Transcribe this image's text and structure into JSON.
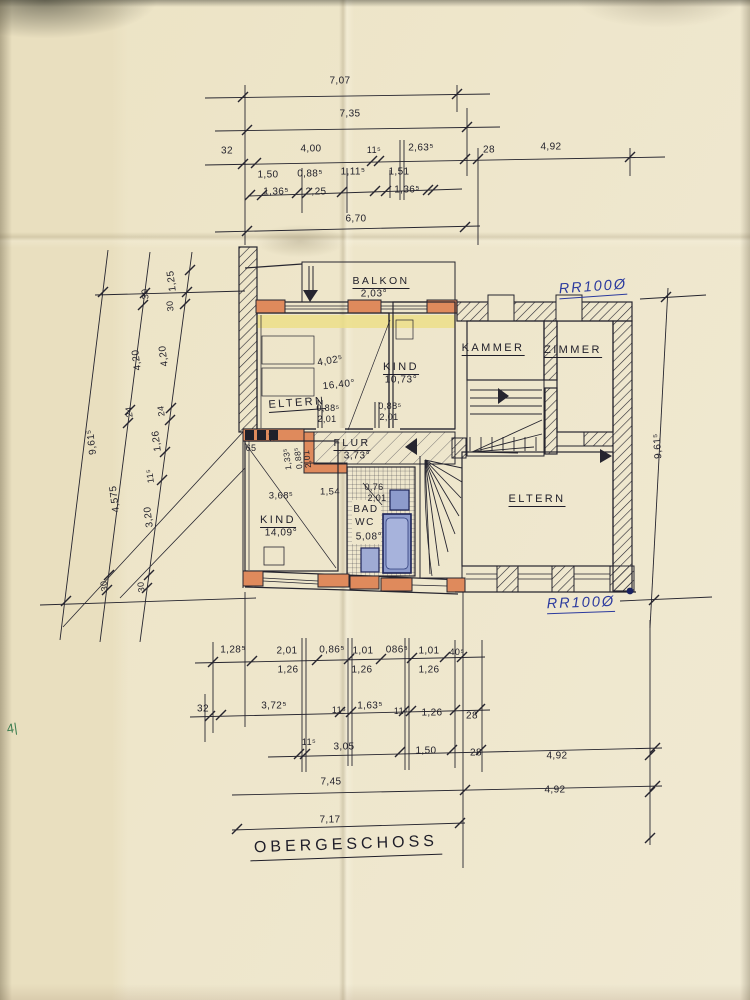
{
  "title": "OBERGESCHOSS",
  "notes": {
    "rr_top": "RR100Ø",
    "rr_bottom": "RR100Ø",
    "green_mark": "4|"
  },
  "rooms": {
    "balkon": {
      "name": "BALKON",
      "area": "2,03°"
    },
    "eltern_top": {
      "name": "ELTERN",
      "area": "16,40°",
      "width": "4,02⁵"
    },
    "kind_top": {
      "name": "KIND",
      "area": "10,73°"
    },
    "kammer": {
      "name": "KAMMER"
    },
    "zimmer": {
      "name": "ZIMMER"
    },
    "flur": {
      "name": "FLUR",
      "area": "3,73°"
    },
    "kind_bottom": {
      "name": "KIND",
      "area": "14,09°"
    },
    "bad": {
      "name": "BAD",
      "name2": "WC",
      "area": "5,08°"
    },
    "eltern_bottom": {
      "name": "ELTERN"
    }
  },
  "colors": {
    "paper": "#eee6cb",
    "ink": "#26252f",
    "wall_orange": "#df8a5c",
    "band_yellow": "#ecdf84",
    "fixture_blue": "#8d9bcc",
    "note_blue": "#2b3a9e",
    "mark_green": "#3c7d50"
  },
  "dim_labels": [
    {
      "t": "7,07",
      "x": 340,
      "y": 81
    },
    {
      "t": "7,35",
      "x": 350,
      "y": 114
    },
    {
      "t": "32",
      "x": 227,
      "y": 151
    },
    {
      "t": "4,00",
      "x": 311,
      "y": 149
    },
    {
      "t": "11⁵",
      "x": 374,
      "y": 150,
      "fs": 9
    },
    {
      "t": "2,63⁵",
      "x": 421,
      "y": 148
    },
    {
      "t": "28",
      "x": 489,
      "y": 150
    },
    {
      "t": "4,92",
      "x": 551,
      "y": 147
    },
    {
      "t": "1,50",
      "x": 268,
      "y": 175
    },
    {
      "t": "0,88⁵",
      "x": 310,
      "y": 174
    },
    {
      "t": "1,11⁵",
      "x": 353,
      "y": 172
    },
    {
      "t": "1,51",
      "x": 399,
      "y": 172
    },
    {
      "t": "1,36⁵",
      "x": 276,
      "y": 192
    },
    {
      "t": "2,25",
      "x": 316,
      "y": 192
    },
    {
      "t": "1,36⁵",
      "x": 407,
      "y": 190
    },
    {
      "t": "6,70",
      "x": 356,
      "y": 219
    },
    {
      "t": "1,25",
      "x": 172,
      "y": 281,
      "r": -97
    },
    {
      "t": "30",
      "x": 145,
      "y": 294,
      "r": -97,
      "fs": 9
    },
    {
      "t": "30",
      "x": 170,
      "y": 306,
      "r": -97,
      "fs": 9
    },
    {
      "t": "4,20",
      "x": 137,
      "y": 360,
      "r": -97
    },
    {
      "t": "4,20",
      "x": 164,
      "y": 356,
      "r": -97
    },
    {
      "t": "24",
      "x": 129,
      "y": 412,
      "r": -97,
      "fs": 9
    },
    {
      "t": "24",
      "x": 161,
      "y": 411,
      "r": -97,
      "fs": 9
    },
    {
      "t": "1,26",
      "x": 157,
      "y": 441,
      "r": -97
    },
    {
      "t": "9,61⁵",
      "x": 92,
      "y": 442,
      "r": -97
    },
    {
      "t": "11⁵",
      "x": 150,
      "y": 476,
      "r": -97,
      "fs": 9
    },
    {
      "t": "4,575",
      "x": 115,
      "y": 499,
      "r": -97
    },
    {
      "t": "3,20",
      "x": 149,
      "y": 517,
      "r": -97
    },
    {
      "t": "30",
      "x": 104,
      "y": 586,
      "r": -97,
      "fs": 9
    },
    {
      "t": "30",
      "x": 141,
      "y": 587,
      "r": -97,
      "fs": 9
    },
    {
      "t": "9,61⁵",
      "x": 658,
      "y": 446,
      "r": -94
    },
    {
      "t": "4,02⁵",
      "x": 330,
      "y": 361,
      "r": -10
    },
    {
      "t": "0,88⁵",
      "x": 328,
      "y": 408,
      "fs": 9
    },
    {
      "t": "2,01",
      "x": 327,
      "y": 419,
      "fs": 9
    },
    {
      "t": "0,88⁵",
      "x": 390,
      "y": 406,
      "fs": 9
    },
    {
      "t": "2,01",
      "x": 389,
      "y": 417,
      "fs": 9
    },
    {
      "t": "65",
      "x": 251,
      "y": 448,
      "fs": 9
    },
    {
      "t": "30",
      "x": 272,
      "y": 436,
      "r": -97,
      "fs": 8
    },
    {
      "t": "1,33⁵",
      "x": 287,
      "y": 459,
      "r": -97,
      "fs": 8.5
    },
    {
      "t": "0,88⁵",
      "x": 298,
      "y": 458,
      "r": -97,
      "fs": 8.5
    },
    {
      "t": "2,01",
      "x": 307,
      "y": 459,
      "r": -97,
      "fs": 8.5
    },
    {
      "t": "3,68⁵",
      "x": 281,
      "y": 496,
      "fs": 9.5
    },
    {
      "t": "1,54",
      "x": 330,
      "y": 492,
      "fs": 9.5
    },
    {
      "t": "0,76",
      "x": 374,
      "y": 487,
      "fs": 9
    },
    {
      "t": "2,01",
      "x": 377,
      "y": 498,
      "fs": 9
    },
    {
      "t": "1,28⁵",
      "x": 233,
      "y": 650
    },
    {
      "t": "2,01",
      "x": 287,
      "y": 651
    },
    {
      "t": "0,86⁵",
      "x": 332,
      "y": 650
    },
    {
      "t": "1,01",
      "x": 363,
      "y": 651
    },
    {
      "t": "086⁵",
      "x": 397,
      "y": 650
    },
    {
      "t": "1,01",
      "x": 429,
      "y": 651
    },
    {
      "t": "40⁵",
      "x": 457,
      "y": 652,
      "fs": 9
    },
    {
      "t": "1,26",
      "x": 288,
      "y": 670
    },
    {
      "t": "1,26",
      "x": 362,
      "y": 670
    },
    {
      "t": "1,26",
      "x": 429,
      "y": 670
    },
    {
      "t": "32",
      "x": 203,
      "y": 709
    },
    {
      "t": "3,72⁵",
      "x": 274,
      "y": 706
    },
    {
      "t": "11⁵",
      "x": 339,
      "y": 710,
      "fs": 9
    },
    {
      "t": "1,63⁵",
      "x": 370,
      "y": 706
    },
    {
      "t": "11⁵",
      "x": 401,
      "y": 711,
      "fs": 9
    },
    {
      "t": "1,26",
      "x": 432,
      "y": 713
    },
    {
      "t": "28",
      "x": 472,
      "y": 716
    },
    {
      "t": "11⁵",
      "x": 309,
      "y": 742,
      "fs": 9
    },
    {
      "t": "3,05",
      "x": 344,
      "y": 747
    },
    {
      "t": "1,50",
      "x": 426,
      "y": 751
    },
    {
      "t": "28",
      "x": 476,
      "y": 753
    },
    {
      "t": "4,92",
      "x": 557,
      "y": 756
    },
    {
      "t": "7,45",
      "x": 331,
      "y": 782
    },
    {
      "t": "4,92",
      "x": 555,
      "y": 790
    },
    {
      "t": "7,17",
      "x": 330,
      "y": 820
    }
  ]
}
